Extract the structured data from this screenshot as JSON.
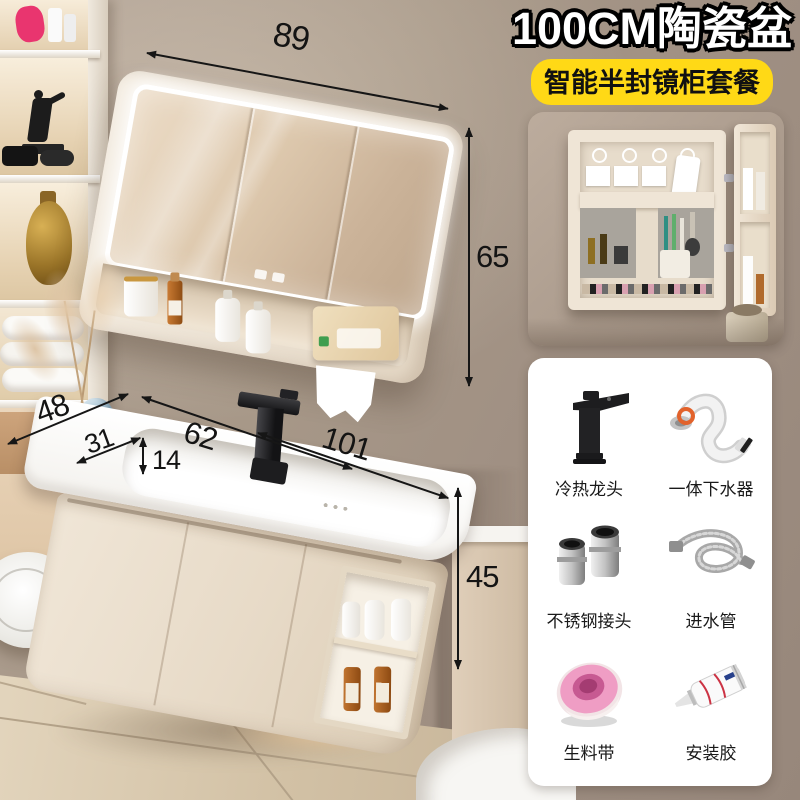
{
  "header": {
    "title": "100CM陶瓷盆",
    "subtitle": "智能半封镜柜套餐",
    "subtitle_bg": "#ffd916"
  },
  "dims": {
    "mirror_width": "89",
    "mirror_height": "65",
    "counter_depth": "48",
    "basin_inner_depth": "31",
    "basin_inner_width": "62",
    "basin_height": "14",
    "counter_width": "101",
    "cabinet_height": "45"
  },
  "accessories": {
    "items": [
      {
        "label": "冷热龙头",
        "icon": "faucet-icon"
      },
      {
        "label": "一体下水器",
        "icon": "drain-pipe-icon"
      },
      {
        "label": "不锈钢接头",
        "icon": "steel-connector-icon"
      },
      {
        "label": "进水管",
        "icon": "inlet-hose-icon"
      },
      {
        "label": "生料带",
        "icon": "thread-seal-tape-icon"
      },
      {
        "label": "安装胶",
        "icon": "adhesive-glue-icon"
      }
    ]
  },
  "colors": {
    "wall": "#a79888",
    "cabinet_cream": "#ece1d0",
    "counter_white": "#faf9f7",
    "floor": "#d7c6ac",
    "badge_yellow": "#ffd916",
    "faucet_black": "#1c1c1e"
  }
}
